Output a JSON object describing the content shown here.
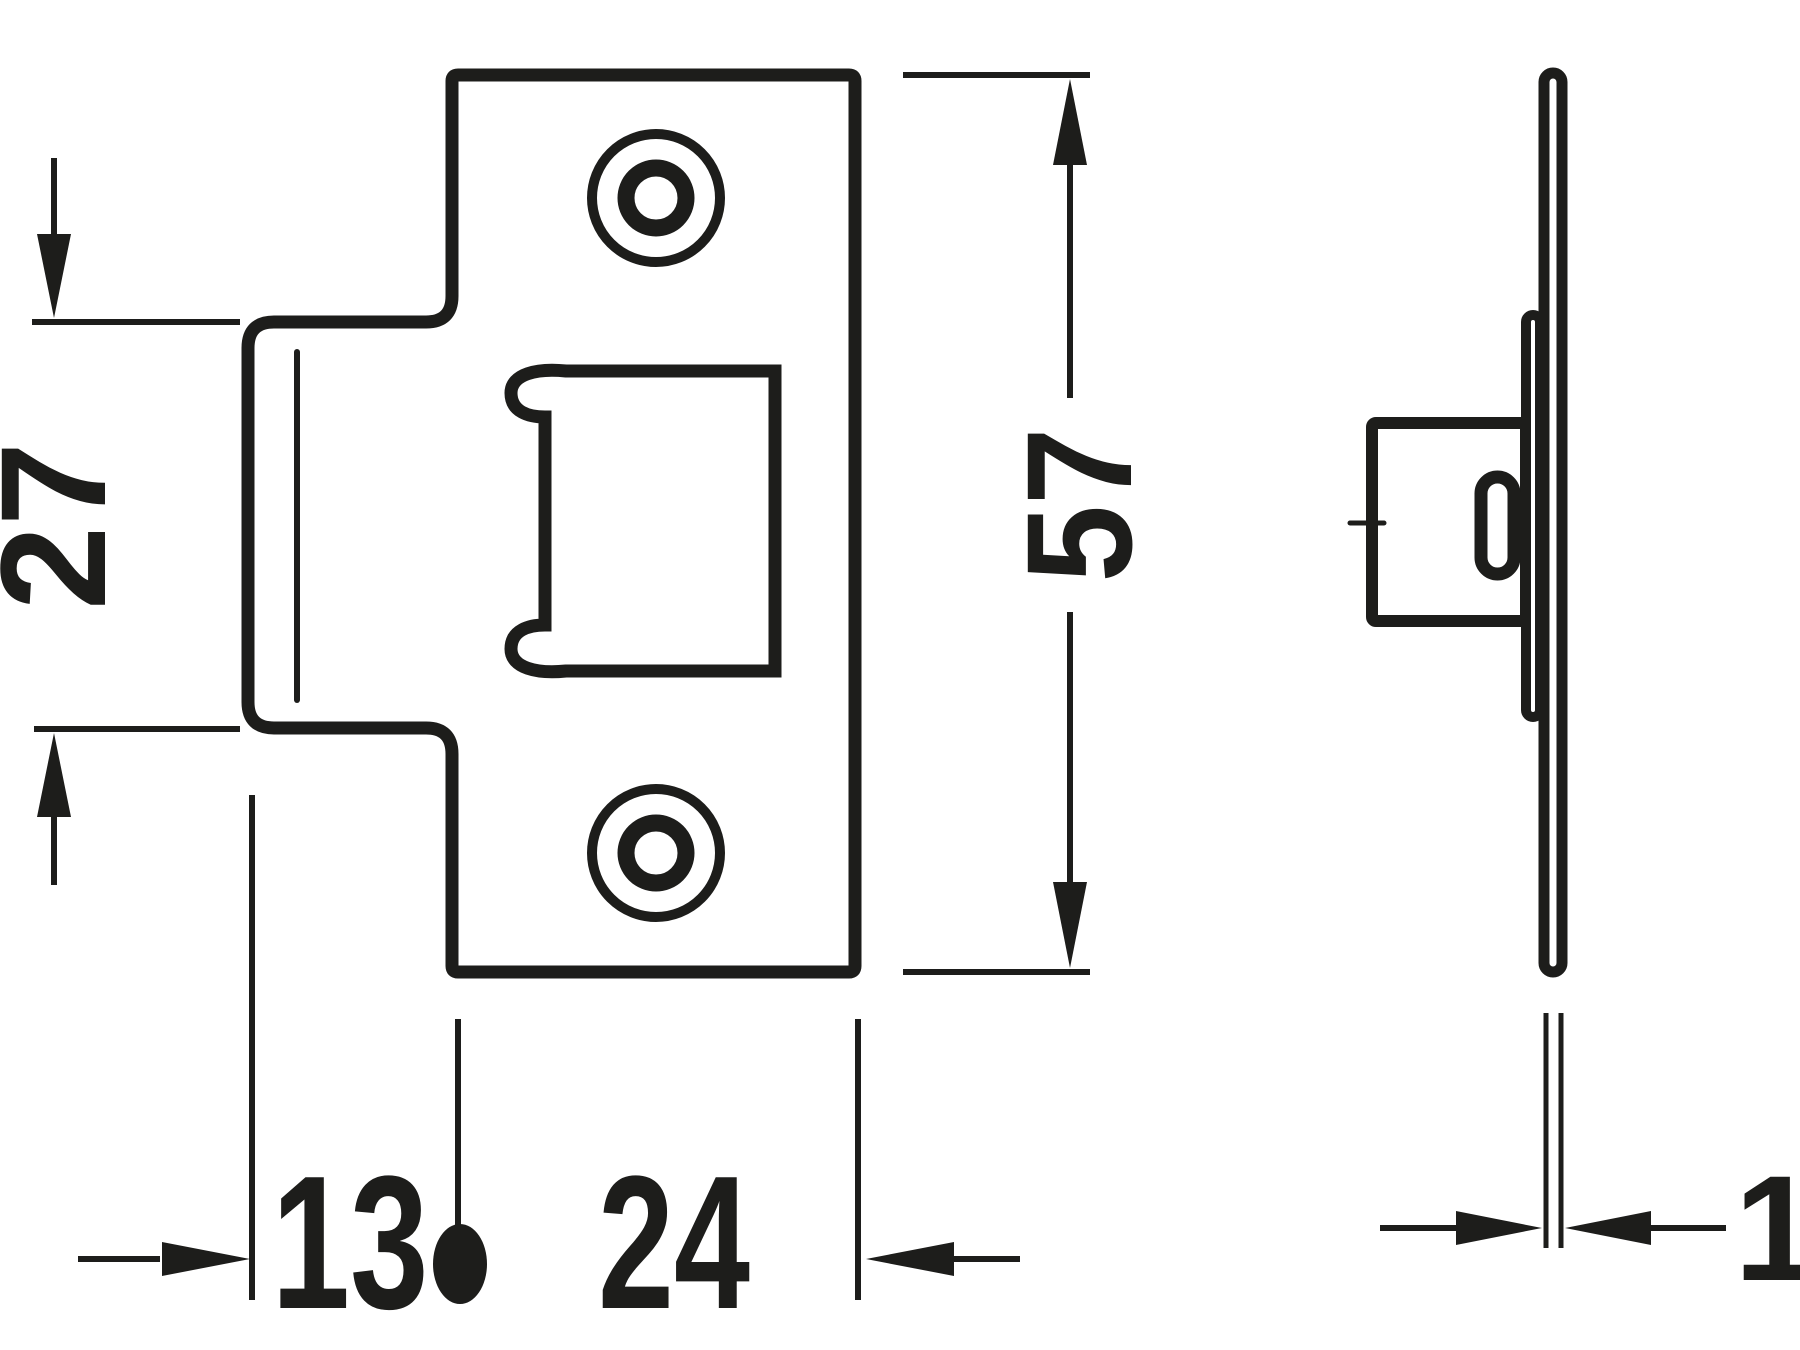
{
  "colors": {
    "ink": "#1d1d1b",
    "background": "#ffffff"
  },
  "dimensions": {
    "tab_height_mm": "27",
    "plate_height_mm": "57",
    "tab_offset_mm": "13",
    "plate_width_mm": "24",
    "plate_thickness_mm": "1"
  }
}
